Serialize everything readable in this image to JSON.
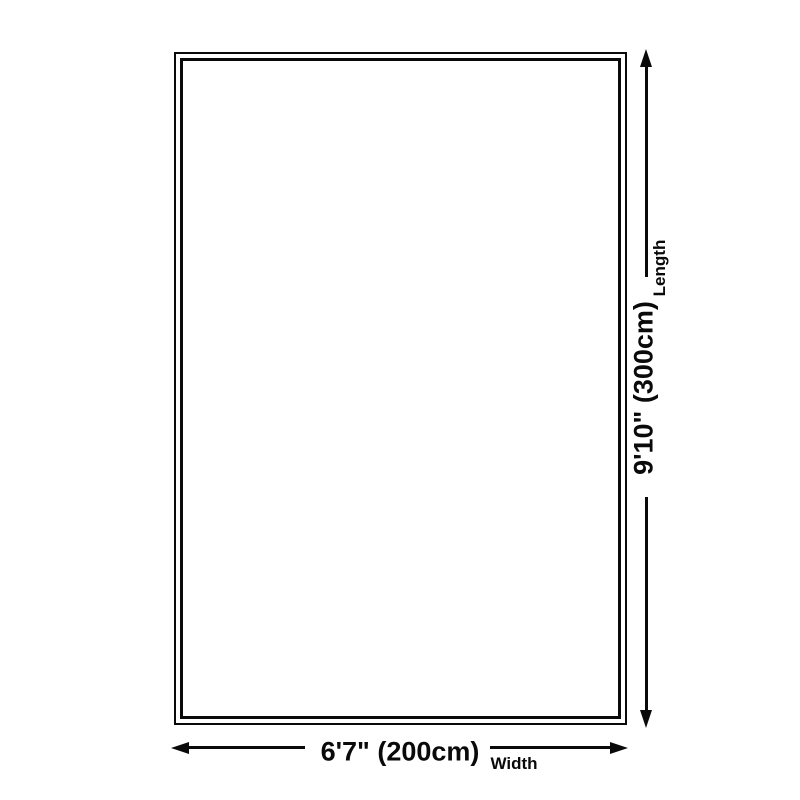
{
  "diagram": {
    "name": "rug-size-diagram",
    "width_dimension": {
      "value": "6'7\" (200cm)",
      "label": "Width"
    },
    "length_dimension": {
      "value": "9'10\" (300cm)",
      "label": "Length"
    }
  },
  "colors": {
    "line": "#0a0a0a",
    "background": "#ffffff"
  }
}
